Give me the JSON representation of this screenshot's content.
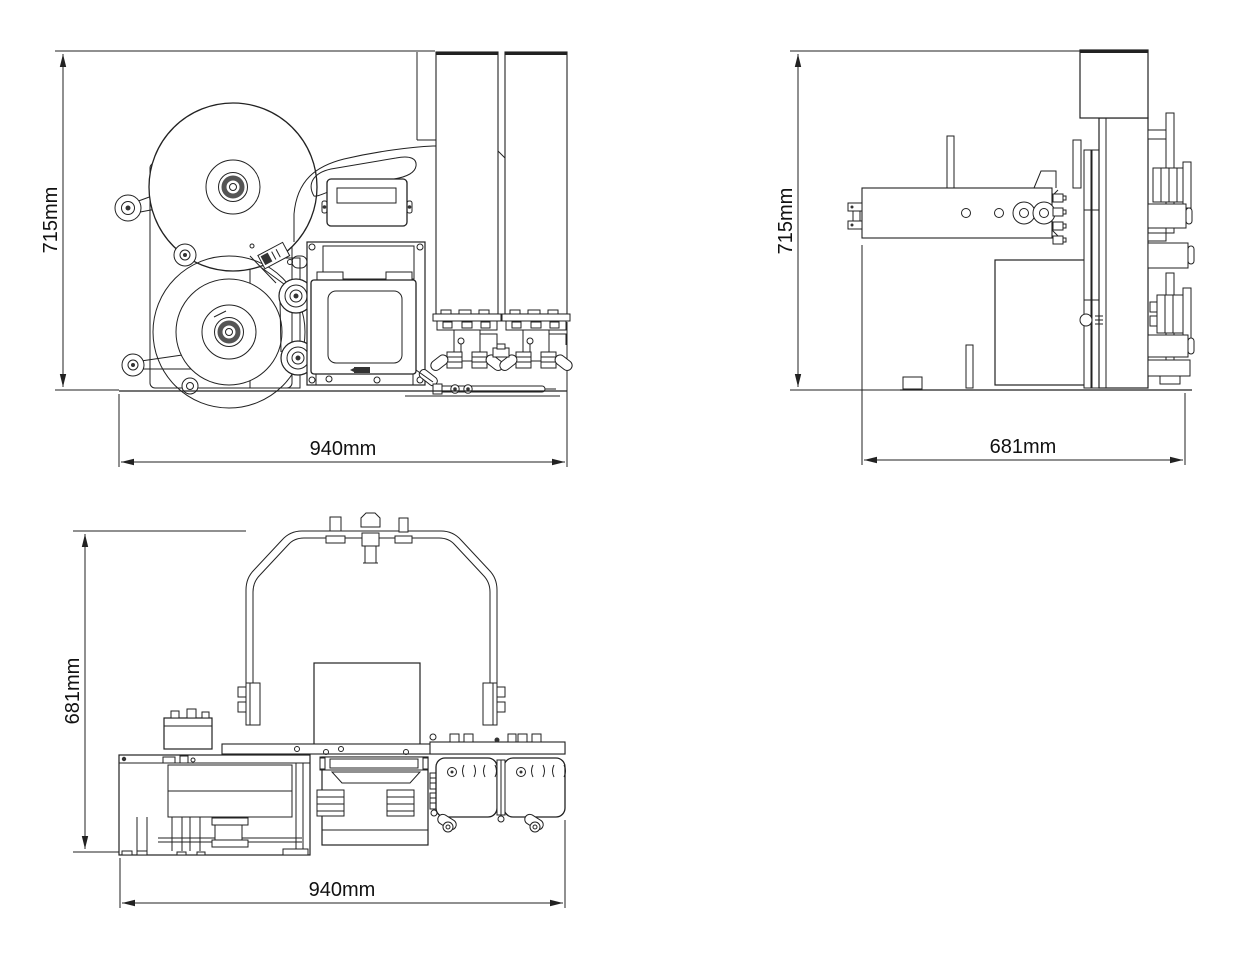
{
  "drawing": {
    "background": "#ffffff",
    "line_color": "#222222",
    "views": {
      "front": {
        "height_label": "715mm",
        "width_label": "940mm"
      },
      "side": {
        "height_label": "715mm",
        "width_label": "681mm"
      },
      "top": {
        "depth_label": "681mm",
        "width_label": "940mm"
      }
    }
  }
}
